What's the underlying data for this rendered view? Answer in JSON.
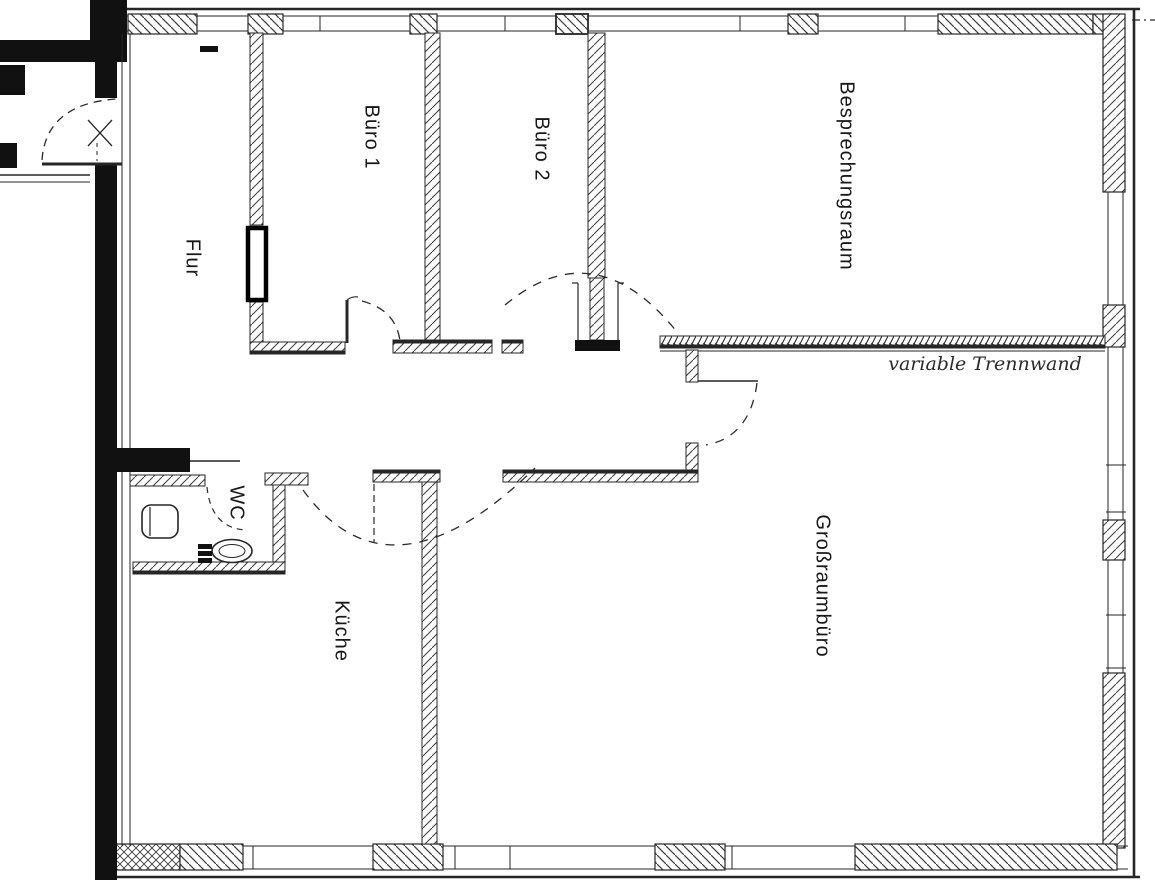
{
  "document": {
    "type": "scanned office floor plan",
    "background_color": "#ffffff",
    "ink_color": "#1a1a1a"
  },
  "rooms": [
    {
      "name": "Flur",
      "cx": 192,
      "cy": 258,
      "rotated": true
    },
    {
      "name": "Büro 1",
      "cx": 371,
      "cy": 137,
      "rotated": true
    },
    {
      "name": "Büro 2",
      "cx": 541,
      "cy": 149,
      "rotated": true
    },
    {
      "name": "Besprechungsraum",
      "cx": 846,
      "cy": 176,
      "rotated": true
    },
    {
      "name": "WC",
      "cx": 236,
      "cy": 503,
      "rotated": true
    },
    {
      "name": "Küche",
      "cx": 341,
      "cy": 631,
      "rotated": true
    },
    {
      "name": "Großraumbüro",
      "cx": 822,
      "cy": 586,
      "rotated": true
    }
  ],
  "annotations": [
    {
      "name": "variable Trennwand",
      "cx": 985,
      "cy": 364,
      "style": "italic"
    }
  ]
}
